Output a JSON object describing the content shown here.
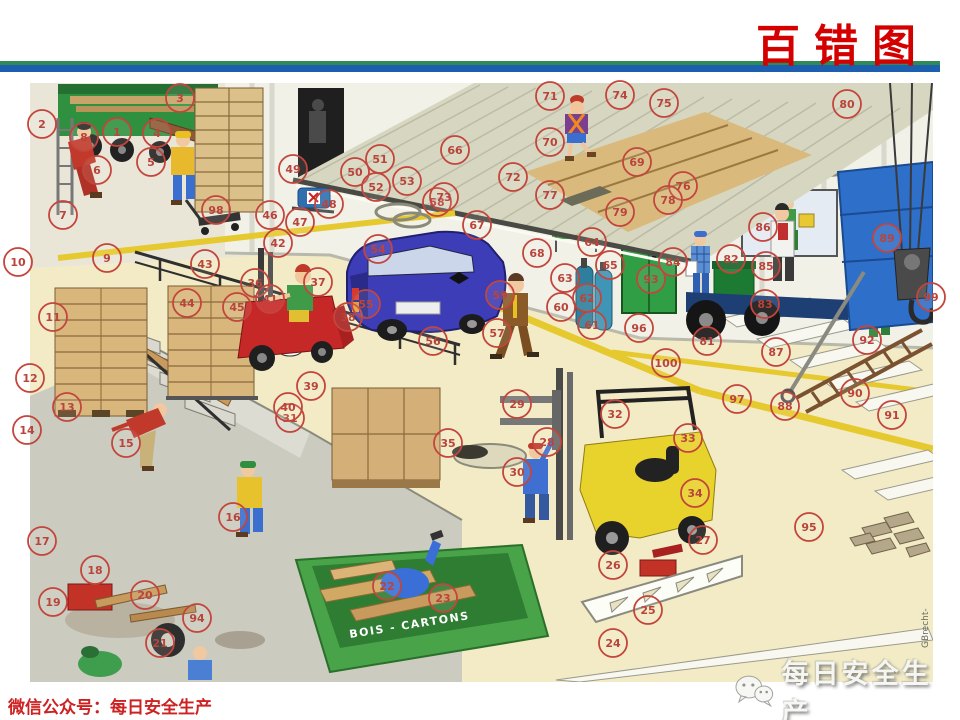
{
  "slide": {
    "title": "百错图",
    "footer_wechat": "微信公众号：每日安全生产",
    "watermark_text": "每日安全生产",
    "watermark_icon": "wechat-logo-icon",
    "signature": "GBrecht-",
    "dumpster_label": "BOIS - CARTONS",
    "colors": {
      "title_red": "#d40000",
      "divider_green": "#2e8b57",
      "divider_blue": "#1b5fae",
      "marker_red": "#c3453c",
      "floor_cream": "#f2ebc6",
      "pit_gray": "#cbcbc0"
    }
  },
  "markers": [
    {
      "n": 1,
      "x": 117,
      "y": 132
    },
    {
      "n": 2,
      "x": 42,
      "y": 124
    },
    {
      "n": 3,
      "x": 180,
      "y": 98
    },
    {
      "n": 4,
      "x": 157,
      "y": 133
    },
    {
      "n": 5,
      "x": 151,
      "y": 162
    },
    {
      "n": 6,
      "x": 97,
      "y": 170
    },
    {
      "n": 7,
      "x": 63,
      "y": 215
    },
    {
      "n": 8,
      "x": 84,
      "y": 137
    },
    {
      "n": 9,
      "x": 107,
      "y": 258
    },
    {
      "n": 10,
      "x": 18,
      "y": 262
    },
    {
      "n": 11,
      "x": 53,
      "y": 317
    },
    {
      "n": 12,
      "x": 30,
      "y": 378
    },
    {
      "n": 13,
      "x": 67,
      "y": 407
    },
    {
      "n": 14,
      "x": 27,
      "y": 430
    },
    {
      "n": 15,
      "x": 126,
      "y": 443
    },
    {
      "n": 16,
      "x": 233,
      "y": 517
    },
    {
      "n": 17,
      "x": 42,
      "y": 541
    },
    {
      "n": 18,
      "x": 95,
      "y": 570
    },
    {
      "n": 19,
      "x": 53,
      "y": 602
    },
    {
      "n": 20,
      "x": 145,
      "y": 595
    },
    {
      "n": 21,
      "x": 160,
      "y": 643
    },
    {
      "n": 22,
      "x": 387,
      "y": 586
    },
    {
      "n": 23,
      "x": 443,
      "y": 598
    },
    {
      "n": 24,
      "x": 613,
      "y": 643
    },
    {
      "n": 25,
      "x": 648,
      "y": 610
    },
    {
      "n": 26,
      "x": 613,
      "y": 565
    },
    {
      "n": 27,
      "x": 703,
      "y": 540
    },
    {
      "n": 28,
      "x": 547,
      "y": 442
    },
    {
      "n": 29,
      "x": 517,
      "y": 404
    },
    {
      "n": 30,
      "x": 517,
      "y": 472
    },
    {
      "n": 31,
      "x": 290,
      "y": 418
    },
    {
      "n": 32,
      "x": 615,
      "y": 414
    },
    {
      "n": 33,
      "x": 688,
      "y": 438
    },
    {
      "n": 34,
      "x": 695,
      "y": 493
    },
    {
      "n": 35,
      "x": 448,
      "y": 443
    },
    {
      "n": 36,
      "x": 255,
      "y": 283
    },
    {
      "n": 37,
      "x": 318,
      "y": 282
    },
    {
      "n": 38,
      "x": 348,
      "y": 317
    },
    {
      "n": 39,
      "x": 311,
      "y": 386
    },
    {
      "n": 40,
      "x": 288,
      "y": 407
    },
    {
      "n": 41,
      "x": 270,
      "y": 299
    },
    {
      "n": 42,
      "x": 278,
      "y": 243
    },
    {
      "n": 43,
      "x": 205,
      "y": 264
    },
    {
      "n": 44,
      "x": 187,
      "y": 303
    },
    {
      "n": 45,
      "x": 237,
      "y": 307
    },
    {
      "n": 46,
      "x": 270,
      "y": 215
    },
    {
      "n": 47,
      "x": 300,
      "y": 222
    },
    {
      "n": 48,
      "x": 329,
      "y": 204
    },
    {
      "n": 49,
      "x": 293,
      "y": 169
    },
    {
      "n": 50,
      "x": 355,
      "y": 172
    },
    {
      "n": 51,
      "x": 380,
      "y": 159
    },
    {
      "n": 52,
      "x": 376,
      "y": 187
    },
    {
      "n": 53,
      "x": 407,
      "y": 181
    },
    {
      "n": 54,
      "x": 378,
      "y": 249
    },
    {
      "n": 55,
      "x": 366,
      "y": 304
    },
    {
      "n": 56,
      "x": 433,
      "y": 341
    },
    {
      "n": 57,
      "x": 497,
      "y": 333
    },
    {
      "n": 58,
      "x": 437,
      "y": 202
    },
    {
      "n": 59,
      "x": 500,
      "y": 295
    },
    {
      "n": 60,
      "x": 561,
      "y": 307
    },
    {
      "n": 61,
      "x": 592,
      "y": 325
    },
    {
      "n": 62,
      "x": 587,
      "y": 298
    },
    {
      "n": 63,
      "x": 565,
      "y": 278
    },
    {
      "n": 64,
      "x": 592,
      "y": 242
    },
    {
      "n": 65,
      "x": 610,
      "y": 265
    },
    {
      "n": 66,
      "x": 455,
      "y": 150
    },
    {
      "n": 67,
      "x": 477,
      "y": 225
    },
    {
      "n": 68,
      "x": 537,
      "y": 253
    },
    {
      "n": 69,
      "x": 637,
      "y": 162
    },
    {
      "n": 70,
      "x": 550,
      "y": 142
    },
    {
      "n": 71,
      "x": 550,
      "y": 96
    },
    {
      "n": 72,
      "x": 513,
      "y": 177
    },
    {
      "n": 73,
      "x": 444,
      "y": 197
    },
    {
      "n": 74,
      "x": 620,
      "y": 95
    },
    {
      "n": 75,
      "x": 664,
      "y": 103
    },
    {
      "n": 76,
      "x": 683,
      "y": 186
    },
    {
      "n": 77,
      "x": 550,
      "y": 195
    },
    {
      "n": 78,
      "x": 668,
      "y": 200
    },
    {
      "n": 79,
      "x": 620,
      "y": 212
    },
    {
      "n": 80,
      "x": 847,
      "y": 104
    },
    {
      "n": 81,
      "x": 707,
      "y": 341
    },
    {
      "n": 82,
      "x": 731,
      "y": 259
    },
    {
      "n": 83,
      "x": 765,
      "y": 304
    },
    {
      "n": 84,
      "x": 673,
      "y": 262
    },
    {
      "n": 85,
      "x": 766,
      "y": 266
    },
    {
      "n": 86,
      "x": 763,
      "y": 227
    },
    {
      "n": 87,
      "x": 776,
      "y": 352
    },
    {
      "n": 88,
      "x": 785,
      "y": 406
    },
    {
      "n": 89,
      "x": 887,
      "y": 238
    },
    {
      "n": 90,
      "x": 855,
      "y": 393
    },
    {
      "n": 91,
      "x": 892,
      "y": 415
    },
    {
      "n": 92,
      "x": 867,
      "y": 340
    },
    {
      "n": 93,
      "x": 651,
      "y": 279
    },
    {
      "n": 94,
      "x": 197,
      "y": 618
    },
    {
      "n": 95,
      "x": 809,
      "y": 527
    },
    {
      "n": 96,
      "x": 639,
      "y": 328
    },
    {
      "n": 97,
      "x": 737,
      "y": 399
    },
    {
      "n": 98,
      "x": 216,
      "y": 210
    },
    {
      "n": 99,
      "x": 931,
      "y": 297
    },
    {
      "n": 100,
      "x": 666,
      "y": 363
    }
  ]
}
